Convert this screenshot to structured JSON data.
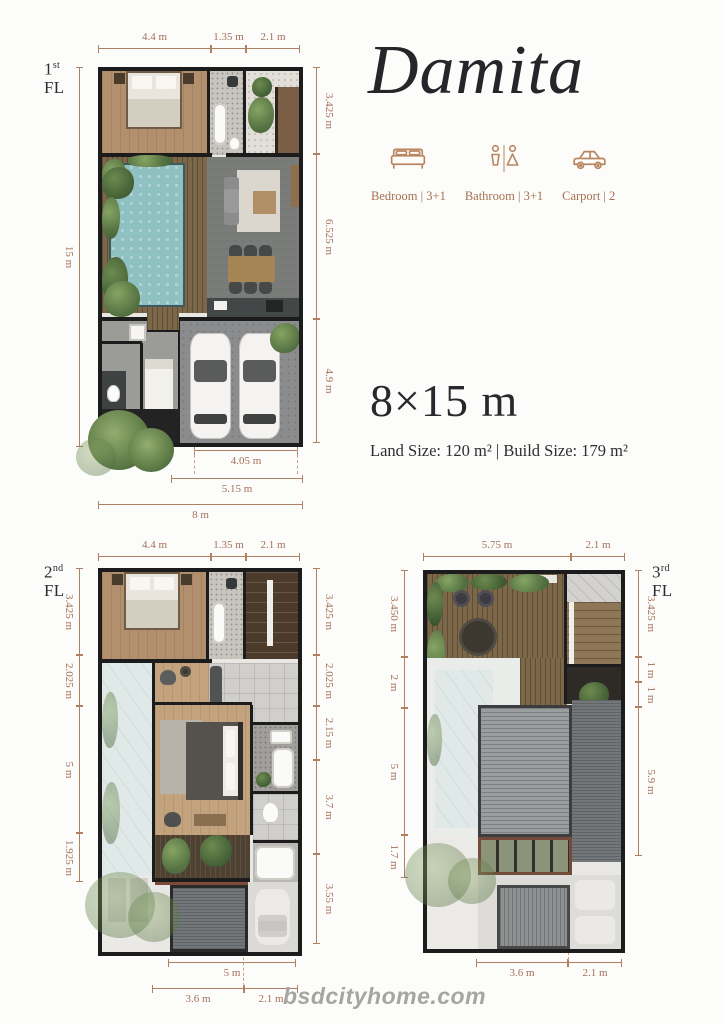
{
  "header": {
    "title": "Damita",
    "size": "8×15 m",
    "area": "Land Size: 120 m² | Build Size: 179 m²"
  },
  "specs": [
    {
      "icon": "bed-icon",
      "label": "Bedroom | 3+1"
    },
    {
      "icon": "bathroom-icon",
      "label": "Bathroom | 3+1"
    },
    {
      "icon": "carport-icon",
      "label": "Carport | 2"
    }
  ],
  "floors": {
    "fl1": {
      "num": "1",
      "ord": "st",
      "fl": "FL",
      "top": [
        "4.4 m",
        "1.35 m",
        "2.1 m"
      ],
      "left": [
        "15 m"
      ],
      "right": [
        "3.425 m",
        "6.525 m",
        "4.9 m"
      ],
      "bottom": [
        "2.7 m",
        "4.05 m",
        "5.15 m",
        "8 m"
      ]
    },
    "fl2": {
      "num": "2",
      "ord": "nd",
      "fl": "FL",
      "top": [
        "4.4 m",
        "1.35 m",
        "2.1 m"
      ],
      "left": [
        "3.425 m",
        "2.025 m",
        "5 m",
        "1.925 m"
      ],
      "right": [
        "3.425 m",
        "2.025 m",
        "2.15 m",
        "3.7 m",
        "3.55 m"
      ],
      "bottom": [
        "5 m",
        "3.6 m",
        "2.1 m"
      ]
    },
    "fl3": {
      "num": "3",
      "ord": "rd",
      "fl": "FL",
      "top": [
        "5.75 m",
        "2.1 m"
      ],
      "left": [
        "3.450 m",
        "2 m",
        "5 m",
        "1.7 m"
      ],
      "right": [
        "3.425 m",
        "1 m",
        "1 m",
        "5.9 m"
      ],
      "bottom": [
        "3.6 m",
        "2.1 m"
      ]
    }
  },
  "footer": {
    "watermark": "bsdcityhome.com"
  },
  "colors": {
    "accent": "#a5705a",
    "title": "#24262a",
    "icon": "#b9865f",
    "pool": "#8fc0c2",
    "wood": "#b2906d",
    "wall": "#1c1c1c"
  }
}
